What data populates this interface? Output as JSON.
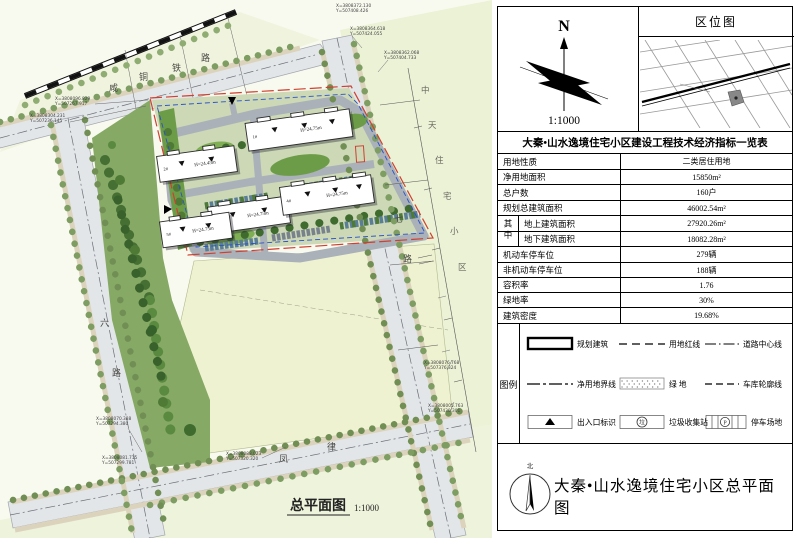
{
  "panel": {
    "north_arrow": {
      "label": "N",
      "scale": "1:1000"
    },
    "location_map": {
      "title": "区位图"
    },
    "table": {
      "title": "大秦•山水逸境住宅小区建设工程技术经济指标一览表",
      "group_label": "其中",
      "rows": [
        {
          "label": "用地性质",
          "value": "二类居住用地"
        },
        {
          "label": "净用地面积",
          "value": "15850m²"
        },
        {
          "label": "总户数",
          "value": "160户"
        },
        {
          "label": "规划总建筑面积",
          "value": "46002.54m²"
        },
        {
          "label": "地上建筑面积",
          "value": "27920.26m²"
        },
        {
          "label": "地下建筑面积",
          "value": "18082.28m²"
        },
        {
          "label": "机动车停车位",
          "value": "279辆"
        },
        {
          "label": "非机动车停车位",
          "value": "188辆"
        },
        {
          "label": "容积率",
          "value": "1.76"
        },
        {
          "label": "绿地率",
          "value": "30%"
        },
        {
          "label": "建筑密度",
          "value": "19.68%"
        }
      ]
    },
    "legend": {
      "label": "图例",
      "trash_char": "垃",
      "parking_char": "P",
      "items": [
        {
          "label": "规划建筑"
        },
        {
          "label": "用地红线"
        },
        {
          "label": "道路中心线"
        },
        {
          "label": "净用地界线"
        },
        {
          "label": "绿 地"
        },
        {
          "label": "车库轮廓线"
        },
        {
          "label": "出入口标识"
        },
        {
          "label": "垃圾收集站"
        },
        {
          "label": "停车场地"
        }
      ]
    },
    "title_block": {
      "north_char": "北",
      "title": "大秦•山水逸境住宅小区总平面图"
    }
  },
  "plan": {
    "drawing_title": "总平面图",
    "drawing_scale": "1:1000",
    "railway_name": [
      "咸",
      "铜",
      "铁",
      "路"
    ],
    "east_label": [
      "中",
      "天",
      "住",
      "宅",
      "小",
      "区"
    ],
    "left_road": [
      "六",
      "路"
    ],
    "right_road": [
      "七",
      "路"
    ],
    "bottom_road": [
      "凤",
      "律"
    ],
    "buildings": [
      {
        "num": "1#",
        "h": "H=24.75m"
      },
      {
        "num": "2#",
        "h": "H=24.45m"
      },
      {
        "num": "3#",
        "h": "H=24.75m"
      },
      {
        "num": "4#",
        "h": "H=24.75m"
      },
      {
        "num": "5#",
        "h": "H=24.75m"
      }
    ],
    "coords": [
      {
        "l1": "X=3808372.130",
        "l2": "Y=507408.426"
      },
      {
        "l1": "X=3808364.618",
        "l2": "Y=507424.055"
      },
      {
        "l1": "X=3808362.068",
        "l2": "Y=507404.733"
      },
      {
        "l1": "X=3808096.829",
        "l2": "Y=507267.917"
      },
      {
        "l1": "X=3808304.231",
        "l2": "Y=507236.145"
      },
      {
        "l1": "X=3808076.768",
        "l2": "Y=507376.324"
      },
      {
        "l1": "X=3808005.763",
        "l2": "Y=507430.301"
      },
      {
        "l1": "X=3808070.388",
        "l2": "Y=507294.380"
      },
      {
        "l1": "X=3808081.715",
        "l2": "Y=507299.781"
      },
      {
        "l1": "X=3808088.023",
        "l2": "Y=507320.320"
      }
    ],
    "colors": {
      "red_line": "#d04030",
      "blue_line": "#2a51c8",
      "road": "#e3e6e9",
      "lawn": "#eef2d1"
    }
  }
}
